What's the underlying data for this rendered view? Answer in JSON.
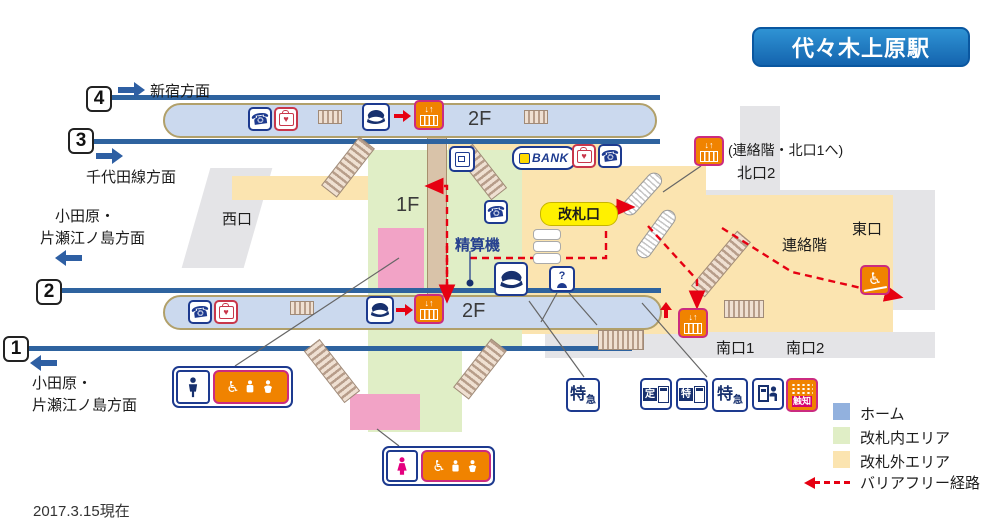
{
  "station": {
    "title": "代々木上原駅",
    "updated": "2017.3.15現在"
  },
  "platforms": [
    {
      "num": "4",
      "direction": "新宿方面",
      "arrow": "right"
    },
    {
      "num": "3",
      "direction": "千代田線方面",
      "arrow": "right"
    },
    {
      "num": "2",
      "direction_line1": "小田原・",
      "direction_line2": "片瀬江ノ島方面",
      "arrow": "left"
    },
    {
      "num": "1",
      "direction_line1": "小田原・",
      "direction_line2": "片瀬江ノ島方面",
      "arrow": "left"
    }
  ],
  "floors": {
    "f1": "1F",
    "f2": "2F"
  },
  "exits": {
    "west": "西口",
    "east": "東口",
    "north2": "北口2",
    "north_elevator_note": "(連絡階・北口1へ)",
    "renraku": "連絡階",
    "south1": "南口1",
    "south2": "南口2"
  },
  "facilities": {
    "gate": "改札口",
    "fare_adjust": "精算機",
    "bank": "BANK"
  },
  "ticket_icons": {
    "ltd_exp_main": "特",
    "ltd_exp_sub": "急",
    "commuter_pass": "定",
    "ltd_short": "特",
    "tactile": "触知"
  },
  "icon_glyphs": {
    "phone": "☎",
    "wheelchair": "♿",
    "elevator_arrows": "↓↑",
    "intercom_q": "?",
    "aed_heart": "♥"
  },
  "legend": {
    "home": "ホーム",
    "inside": "改札内エリア",
    "outside": "改札外エリア",
    "route": "バリアフリー経路",
    "colors": {
      "home": "#92b1de",
      "inside": "#e0eec6",
      "outside": "#fbe4b0",
      "route": "#e60012"
    }
  }
}
